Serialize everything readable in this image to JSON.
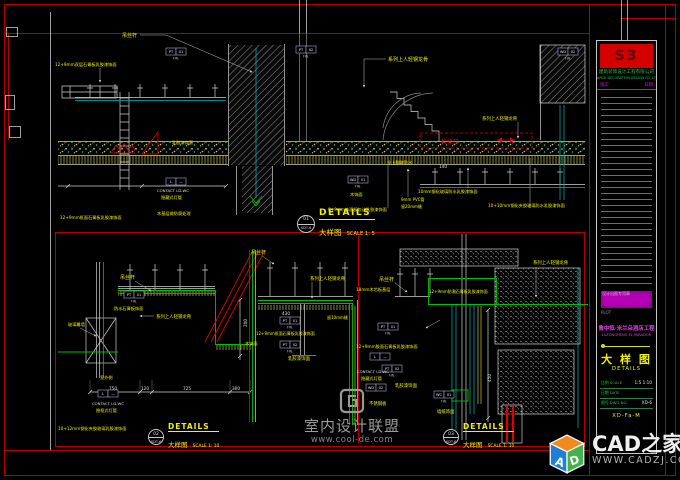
{
  "colors": {
    "cad_yellow": "#f0f000",
    "cad_red": "#e00000",
    "cad_green": "#00c000",
    "cad_cyan": "#00b8b8",
    "cad_magenta": "#d800d8",
    "frame_red": "#b40000",
    "logo_red": "#d40000"
  },
  "tag_fin": "FIN.",
  "details": [
    {
      "id": "01",
      "ref": "XDT-6",
      "title": "DETAILS",
      "subtitle": "大样图",
      "scale": "SCALE 1: 5"
    },
    {
      "id": "02",
      "ref": "XDT-6",
      "title": "DETAILS",
      "subtitle": "大样图",
      "scale": "SCALE 1: 10"
    },
    {
      "id": "03",
      "ref": "XDT-6",
      "title": "DETAILS",
      "subtitle": "大样图",
      "scale": "SCALE 1: 10"
    }
  ],
  "titleblock": {
    "logo": "S3",
    "company_cn": "建筑装饰设计工程有限公司",
    "company_en": "ARCH DECORATION DESIGN CO.,LTD",
    "rev_label": "版次",
    "date_label": "日期",
    "stamp": "设计出图专用章",
    "plot_note": "PLOT",
    "project_cn": "鲁中恒·米兰朵酒店工程",
    "project_en": "LUZONGHENG EL MIRADOR",
    "sheet_title_cn": "大 样 图",
    "sheet_title_en": "DETAILS",
    "fields": [
      {
        "label": "比例 SCALE",
        "value": "1:5 1:10"
      },
      {
        "label": "日期 DATE",
        "value": ""
      },
      {
        "label": "图号 DWG NO.",
        "value": "XD-6"
      }
    ],
    "sheet_no": "XD-Fa-M"
  },
  "watermarks": {
    "center": {
      "name": "室内设计联盟",
      "url": "www.cool-de.com"
    },
    "corner": {
      "name": "CAD之家",
      "url": "WWW.CADZJ.COM",
      "letter_a": "A",
      "letter_d": "D"
    }
  },
  "annotations": [
    [
      "吊丝杆",
      122,
      37,
      "y",
      5
    ],
    [
      "12+9mm双层石膏板乳胶漆饰面",
      55,
      66,
      "y",
      4.2
    ],
    [
      "系列上人轻钢龙骨",
      388,
      61,
      "y",
      5
    ],
    [
      "乳胶漆饰面",
      172,
      144,
      "y",
      4.2
    ],
    [
      "CONTACT LD-WC",
      157,
      192,
      "w",
      3.8
    ],
    [
      "隐藏式灯管",
      161,
      199,
      "y",
      4.2
    ],
    [
      "木饰面",
      350,
      196,
      "y",
      4.2
    ],
    [
      "木基层做防腐处理",
      157,
      215,
      "y",
      4.2
    ],
    [
      "8+9mm饰面板包边乳胶漆饰面",
      328,
      211,
      "y",
      4.2
    ],
    [
      "检修口",
      441,
      144,
      "r",
      6
    ],
    [
      "系列上人轻钢龙骨",
      482,
      120,
      "y",
      4.4
    ],
    [
      "全上翻做防水",
      387,
      164,
      "y",
      4.2
    ],
    [
      "140",
      439,
      168,
      "w",
      4.2
    ],
    [
      "10mm钢化玻璃防水乳胶漆饰面",
      418,
      193,
      "y",
      4.2
    ],
    [
      "10+10mm钢化夹胶玻璃防水乳胶漆饰面",
      488,
      207,
      "y",
      4.2
    ],
    [
      "9mm PVC管",
      401,
      201,
      "y",
      4
    ],
    [
      "留20mm缝",
      401,
      208,
      "y",
      4
    ],
    [
      "12+9mm纸面石膏板乳胶漆饰面",
      60,
      219,
      "y",
      4.2
    ],
    [
      "吊丝杆",
      120,
      279,
      "y",
      5
    ],
    [
      "防水石膏板饰面",
      114,
      310,
      "y",
      4.2
    ],
    [
      "系列上人轻钢龙骨",
      156,
      318,
      "y",
      4.4
    ],
    [
      "玻璃幕墙",
      68,
      326,
      "y",
      4.2
    ],
    [
      "室外侧",
      100,
      379,
      "y",
      4.2
    ],
    [
      "CONTACT LD-WC",
      92,
      405,
      "w",
      3.8
    ],
    [
      "隐框式灯管",
      96,
      412,
      "y",
      4.2
    ],
    [
      "10+12mm钢化夹胶玻璃乳胶漆饰面",
      58,
      430,
      "y",
      4.2
    ],
    [
      "750",
      109,
      390,
      "w",
      4.2
    ],
    [
      "120",
      141,
      390,
      "w",
      4.2
    ],
    [
      "725",
      183,
      390,
      "w",
      4.2
    ],
    [
      "300",
      232,
      390,
      "w",
      4.2
    ],
    [
      "200",
      247,
      327,
      "w",
      4.2,
      -90
    ],
    [
      "吊丝杆",
      251,
      254,
      "y",
      5
    ],
    [
      "系列上人轻钢龙骨",
      310,
      280,
      "y",
      4.4
    ],
    [
      "430",
      282,
      315,
      "w",
      4.2
    ],
    [
      "12+9mm纸面石膏板乳胶漆饰面",
      256,
      335,
      "y",
      4
    ],
    [
      "木饰面",
      245,
      345,
      "y",
      4.2
    ],
    [
      "乳胶漆饰面",
      288,
      360,
      "y",
      4.4
    ],
    [
      "留10mm缝",
      327,
      319,
      "y",
      4
    ],
    [
      "吊丝杆",
      379,
      281,
      "y",
      5
    ],
    [
      "18mm木芯板基层",
      356,
      291,
      "y",
      4.2
    ],
    [
      "系列上人轻钢龙骨",
      533,
      264,
      "y",
      4.4
    ],
    [
      "12+9mm防潮石膏板乳胶漆饰面",
      429,
      293,
      "y",
      4
    ],
    [
      "12+9mm胶面石膏板乳胶漆饰面",
      356,
      348,
      "y",
      4.2
    ],
    [
      "CONTACT LD-WC",
      357,
      373,
      "w",
      3.8
    ],
    [
      "隐藏式灯管",
      361,
      380,
      "y",
      4.2
    ],
    [
      "乳胶漆饰面",
      395,
      387,
      "y",
      4.4
    ],
    [
      "不锈钢板",
      369,
      405,
      "y",
      4.4
    ],
    [
      "墙纸饰面",
      437,
      413,
      "y",
      4.4
    ],
    [
      "450",
      491,
      382,
      "w",
      4.2,
      -90
    ]
  ],
  "tags": [
    [
      166,
      48,
      "PT",
      "01",
      1
    ],
    [
      296,
      46,
      "PT",
      "02",
      1
    ],
    [
      558,
      48,
      "WD",
      "02",
      1
    ],
    [
      166,
      178,
      "L",
      "—",
      0
    ],
    [
      348,
      176,
      "WD",
      "01",
      1
    ],
    [
      124,
      291,
      "PT",
      "01",
      1
    ],
    [
      98,
      390,
      "L",
      "—",
      0
    ],
    [
      280,
      317,
      "PT",
      "01",
      1
    ],
    [
      280,
      341,
      "PT",
      "02",
      1
    ],
    [
      378,
      323,
      "PT",
      "01",
      1
    ],
    [
      370,
      353,
      "L",
      "—",
      0
    ],
    [
      382,
      365,
      "PT",
      "02",
      1
    ],
    [
      366,
      384,
      "WD",
      "02",
      0
    ],
    [
      434,
      391,
      "WC",
      "01",
      1
    ]
  ]
}
